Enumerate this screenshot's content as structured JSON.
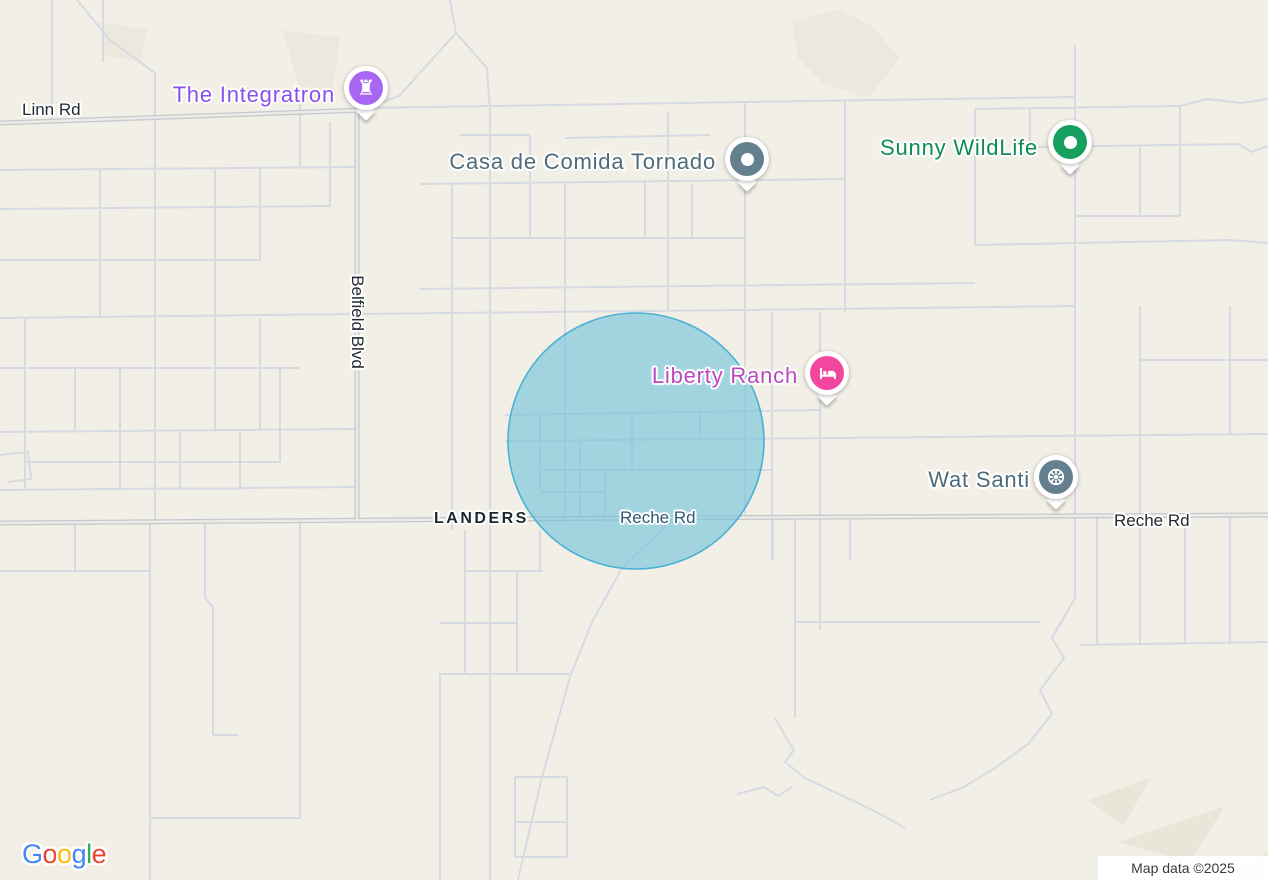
{
  "map": {
    "provider": "Google",
    "background_color": "#f2efe6",
    "road_color_minor": "#d6dae2",
    "road_color_major_casing": "#c3c9d1",
    "road_color_major_fill": "#edebe4"
  },
  "overlay": {
    "radius_circle": {
      "cx": 636,
      "cy": 441,
      "r": 128,
      "fill": "#6dc1dc",
      "stroke": "#45aed4"
    }
  },
  "pois": {
    "integratron": {
      "name": "The Integratron",
      "label_color": "#8a50ec",
      "pin_color": "#a767f2",
      "icon": "castle-tower-icon"
    },
    "casa_de_comida_tornado": {
      "name": "Casa de Comida Tornado",
      "label_color": "#4e6b7a",
      "pin_color": "#64808e",
      "icon": "dot-icon"
    },
    "sunny_wildlife": {
      "name": "Sunny WildLife",
      "label_color": "#0e8a58",
      "pin_color": "#16a05f",
      "icon": "dot-icon"
    },
    "liberty_ranch": {
      "name": "Liberty Ranch",
      "label_color": "#ba48c0",
      "pin_color": "#f2479f",
      "icon": "bed-icon"
    },
    "wat_santi": {
      "name": "Wat Santi",
      "label_color": "#4e6b7a",
      "pin_color": "#64808e",
      "icon": "dharma-wheel-icon"
    }
  },
  "road_labels": {
    "linn": "Linn Rd",
    "belfield": "Belfield Blvd",
    "reche_center": "Reche Rd",
    "reche_east": "Reche Rd"
  },
  "locality": {
    "landers": "LANDERS"
  },
  "attribution": {
    "text": "Map data ©2025"
  },
  "logo": {
    "name": "Google",
    "letters": [
      {
        "ch": "G",
        "color": "#4285F4"
      },
      {
        "ch": "o",
        "color": "#EA4335"
      },
      {
        "ch": "o",
        "color": "#FBBC05"
      },
      {
        "ch": "g",
        "color": "#4285F4"
      },
      {
        "ch": "l",
        "color": "#34A853"
      },
      {
        "ch": "e",
        "color": "#EA4335"
      }
    ]
  }
}
